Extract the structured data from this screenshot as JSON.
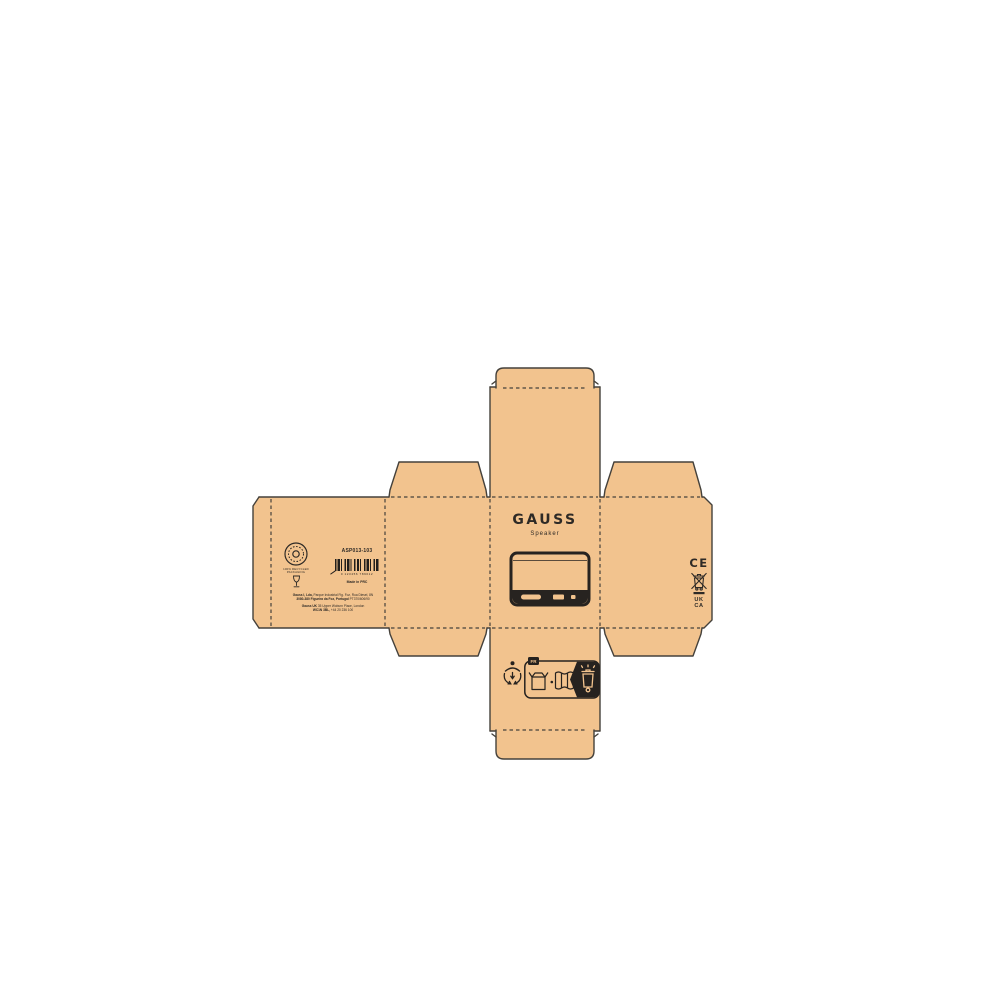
{
  "palette": {
    "background": "#ffffff",
    "cardboard": "#F2C38E",
    "outline": "#45413B",
    "ink": "#2E2A26",
    "ink_black": "#221F1C"
  },
  "front_panel": {
    "brand": "GAUSS",
    "product_name": "Speaker"
  },
  "back_panel": {
    "eco_seal_caption_line1": "100% RECYCLED",
    "eco_seal_caption_line2": "PACKAGING",
    "sku": "ASP013-103",
    "barcode_digits": "0 123456 789012",
    "made_in": "Made in PRC",
    "address_lines": [
      {
        "bold": "Gauss I, Lda,",
        "rest": " Parque Industrial Fig. Foz, Rua Diesel, 8N"
      },
      {
        "bold": "3080-380 Figueira da Foz, Portugal",
        "rest": " PT370/606/90"
      },
      {
        "bold": "Gauss UK",
        "rest": " 35 Upper Woburn Place, London"
      },
      {
        "bold": "WC1N 3BL,",
        "rest": " +44 20 236 100"
      }
    ]
  },
  "right_panel": {
    "ce_mark": "CE",
    "ukca_line1": "UK",
    "ukca_line2": "CA"
  },
  "bottom_panel": {
    "info_tri_tab": "FR"
  },
  "icons": {
    "eco_seal": "circular-recycled-seal",
    "glass": "drinking-glass",
    "weee": "crossed-out-wheelie-bin-with-bar",
    "triman": "triman-recycling-person",
    "info_tri_items": [
      "cardboard-box",
      "paper-leaflet",
      "recycling-bin"
    ]
  }
}
